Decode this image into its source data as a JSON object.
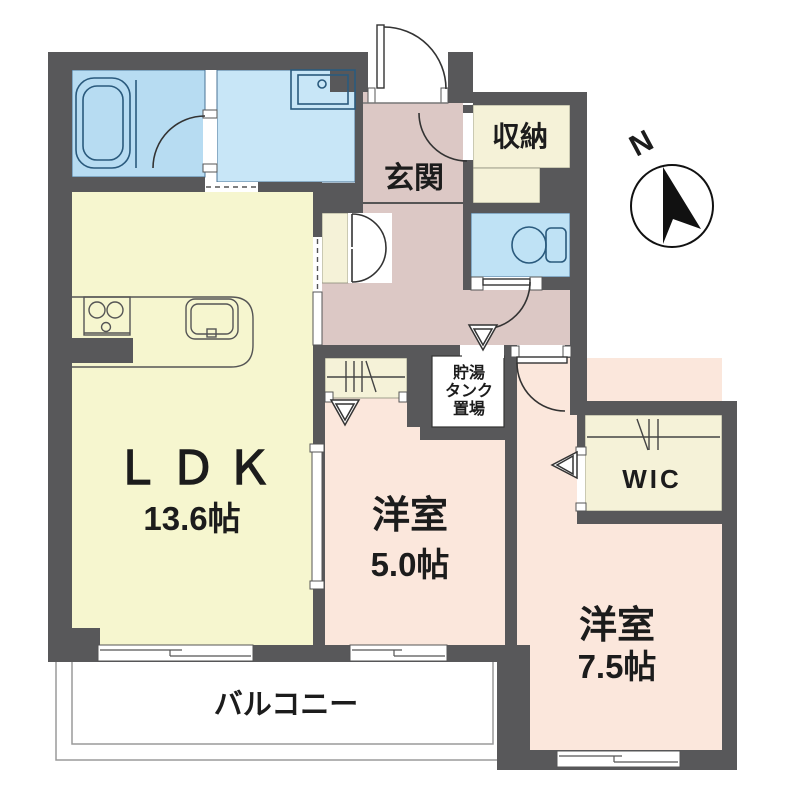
{
  "plan": {
    "type": "floor-plan",
    "compass": {
      "label": "N"
    },
    "rooms": {
      "ldk": {
        "name": "ＬＤＫ",
        "size": "13.6帖"
      },
      "bedroom1": {
        "name": "洋室",
        "size": "5.0帖"
      },
      "bedroom2": {
        "name": "洋室",
        "size": "7.5帖"
      },
      "genkan": {
        "name": "玄関"
      },
      "shunou": {
        "name": "収納"
      },
      "wic": {
        "name": "WIC"
      },
      "tank": {
        "lines": [
          "貯湯",
          "タンク",
          "置場"
        ]
      },
      "balcony": {
        "name": "バルコニー"
      }
    },
    "palette": {
      "wall": "#58585a",
      "ldk": "#f6f6cf",
      "hall": "#dcc8c5",
      "bath": "#b7dcf2",
      "washroom": "#c8e6f7",
      "toilet": "#bfe2f5",
      "closet": "#f5f2d8",
      "bedroom": "#fbe7dc",
      "tank_space": "#ffffff",
      "balcony": "#ffffff"
    }
  }
}
